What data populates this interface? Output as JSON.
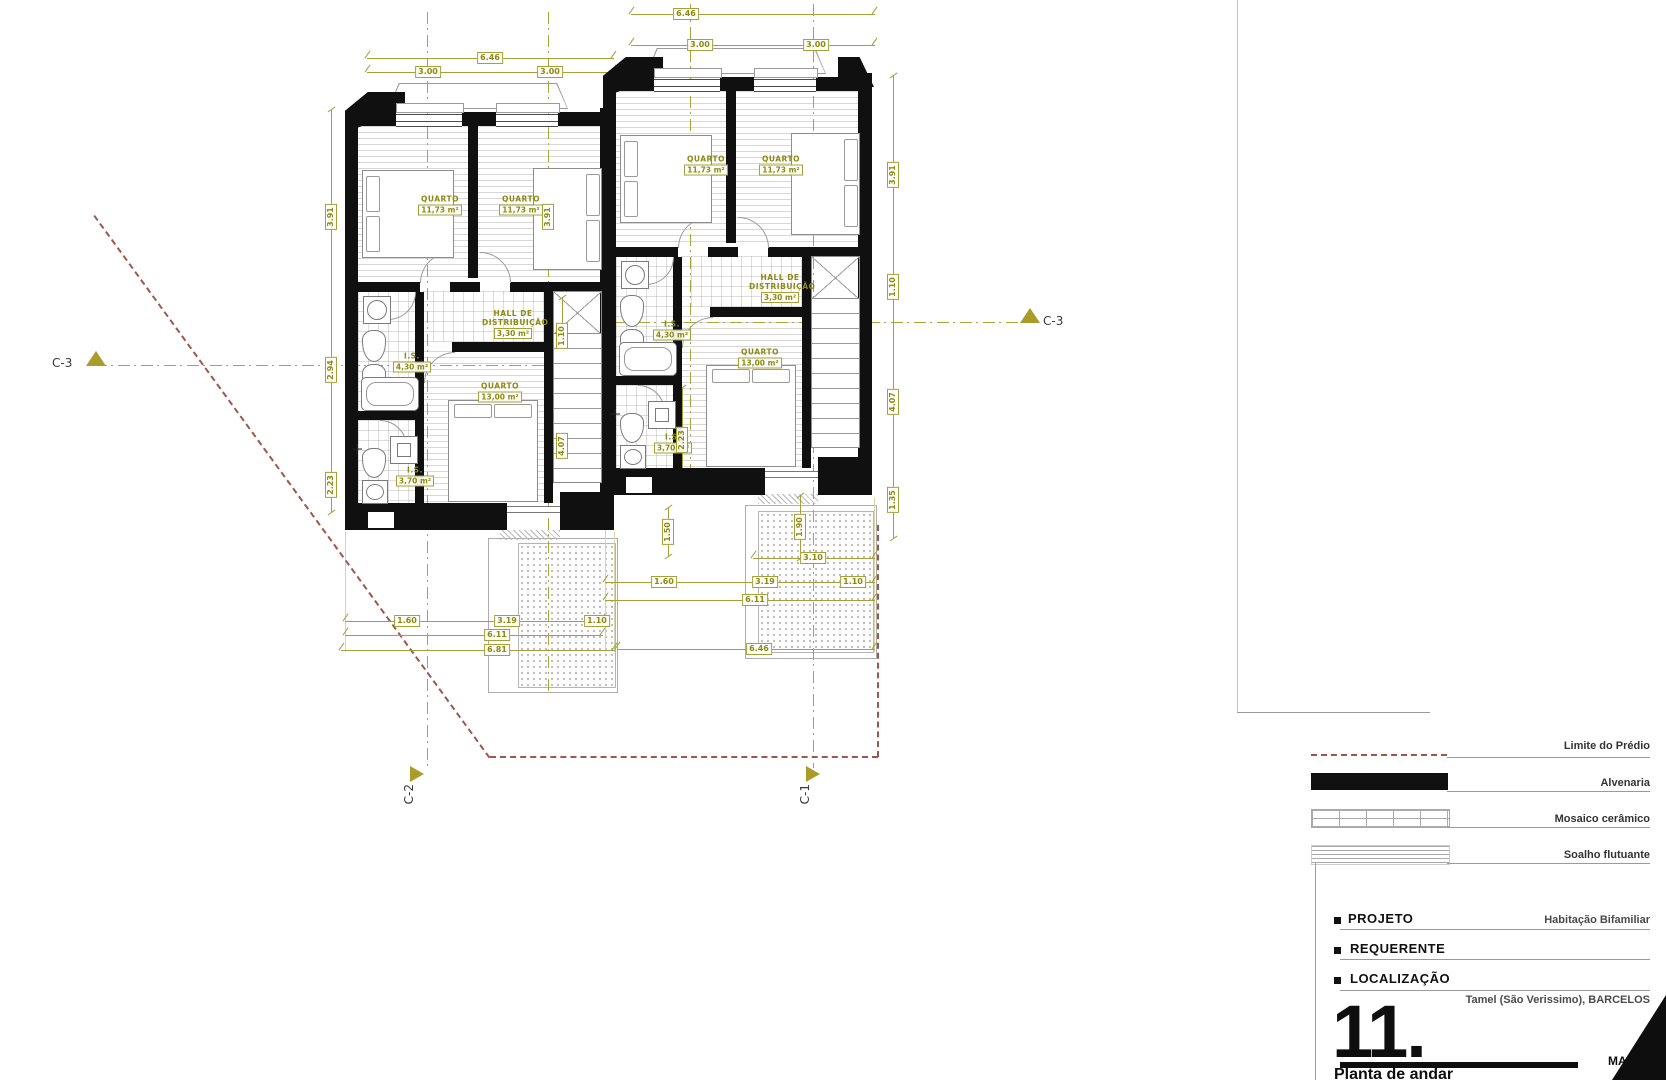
{
  "rooms": {
    "quarto_small": {
      "name": "QUARTO",
      "area": "11,73 m²"
    },
    "hall": {
      "name": "HALL DE DISTRIBUIÇÃO",
      "area": "3,30 m²"
    },
    "is_main": {
      "name": "I.S.",
      "area": "4,30 m²"
    },
    "quarto_main": {
      "name": "QUARTO",
      "area": "13,00 m²"
    },
    "is_small": {
      "name": "I.S.",
      "area": "3,70 m²"
    }
  },
  "dims": {
    "total_width": "6.46",
    "half_width": "3.00",
    "left_top": "3.91",
    "left_mid": "2.94",
    "left_bot": "2.23",
    "right_top": "3.91",
    "right_upper": "1.10",
    "right_lower": "4.07",
    "right_bot": "1.35",
    "int_top": "3.91",
    "int_upper": "1.10",
    "int_lower": "4.07",
    "int_bath": "2.23",
    "bot_a": "1.60",
    "bot_b": "3.19",
    "bot_c": "1.10",
    "bot_mid": "6.11",
    "bot_total_left": "6.81",
    "bot_total_right": "6.46",
    "patio_v1": "1.50",
    "patio_v2": "1.90",
    "patio_w": "3.10"
  },
  "markers": {
    "c1": "C-1",
    "c2": "C-2",
    "c3_left": "C-3",
    "c3_right": "C-3"
  },
  "legend": {
    "items": [
      {
        "label": "Limite do Prédio"
      },
      {
        "label": "Alvenaria"
      },
      {
        "label": "Mosaico cerâmico"
      },
      {
        "label": "Soalho flutuante"
      }
    ]
  },
  "title_block": {
    "projeto_label": "PROJETO",
    "projeto_value": "Habitação Bifamiliar",
    "requerente_label": "REQUERENTE",
    "localizacao_label": "LOCALIZAÇÃO",
    "localizacao_value": "Tamel (São Verissimo), BARCELOS",
    "sheet_number": "11.",
    "sheet_title": "Planta de andar",
    "date": "MAI/2023"
  }
}
